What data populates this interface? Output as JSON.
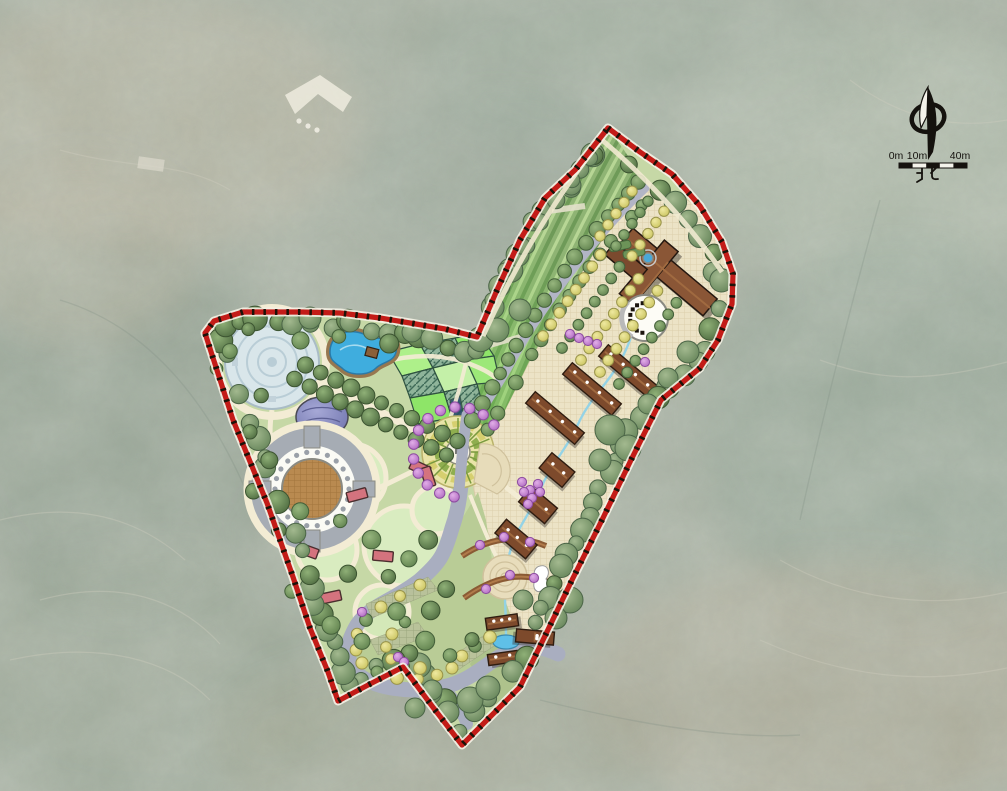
{
  "meta": {
    "title": "landscape master plan over aerial photo"
  },
  "compass": {
    "label": "北"
  },
  "scale_bar": {
    "labels": [
      "0m",
      "10m",
      "40m"
    ]
  },
  "colors": {
    "boundary_red": "#c31c18",
    "water_blue": "#3fadde",
    "pond_blue": "#5fc0e8",
    "building_brown": "#7d4a2c",
    "main_building_brown": "#8a5636",
    "paving_beige": "#ece3c6",
    "lawn_green": "#c6d8a6",
    "field_stripe_green": "#6e9a58",
    "road_gray": "#a9aec0",
    "tree_dark_green": "#4e6b40",
    "tree_yellow": "#c9c35e",
    "flower_purple": "#af6ac0",
    "pavilion_pink": "#d4737e",
    "plaza_blue_gray": "#d9e6ea",
    "amphitheater_brown": "#b98a50",
    "mound_purple": "#8e90c4",
    "ink": "#15120e"
  }
}
